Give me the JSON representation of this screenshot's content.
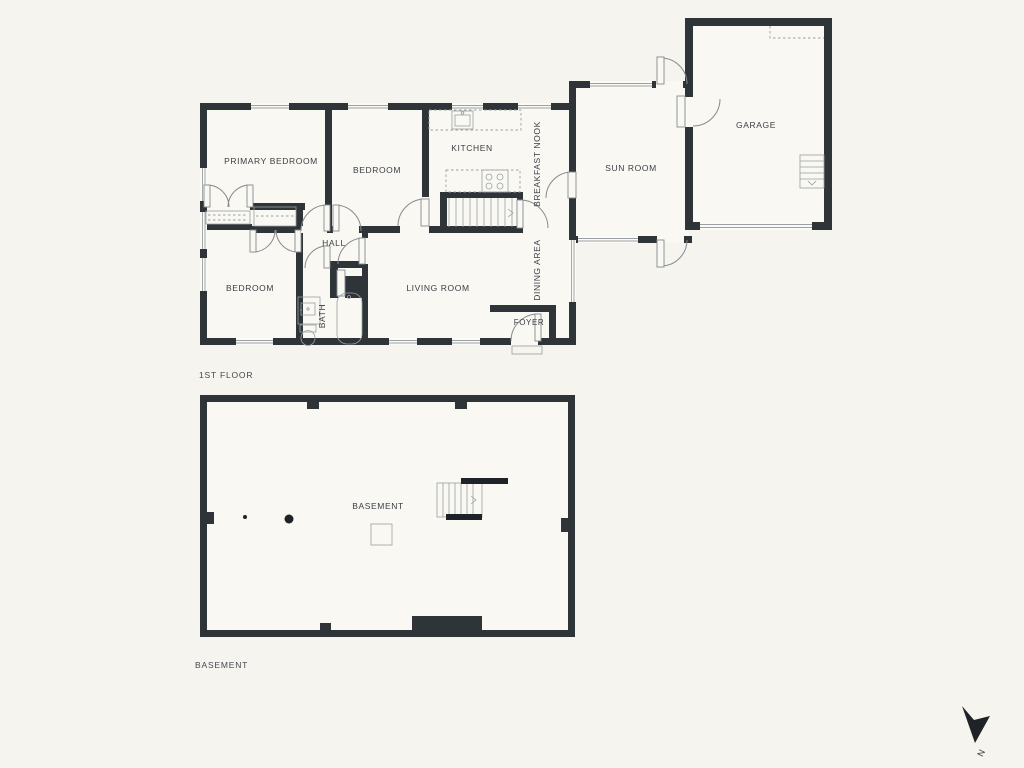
{
  "colors": {
    "background": "#f5f4ee",
    "wall": "#2f3439",
    "interior": "#f9f8f2",
    "fixture_line": "#868b90",
    "text": "#3b4046"
  },
  "floors": {
    "first": {
      "title": "1ST FLOOR",
      "rooms": {
        "primary_bedroom": "PRIMARY BEDROOM",
        "bedroom_top": "BEDROOM",
        "kitchen": "KITCHEN",
        "breakfast_nook": "BREAKFAST NOOK",
        "sun_room": "SUN ROOM",
        "garage": "GARAGE",
        "hall": "HALL",
        "bedroom_bottom": "BEDROOM",
        "bath": "BATH",
        "living_room": "LIVING ROOM",
        "dining_area": "DINING AREA",
        "foyer": "FOYER"
      }
    },
    "basement": {
      "title": "BASEMENT",
      "rooms": {
        "basement": "BASEMENT"
      }
    }
  },
  "compass": {
    "north_label": "N"
  }
}
